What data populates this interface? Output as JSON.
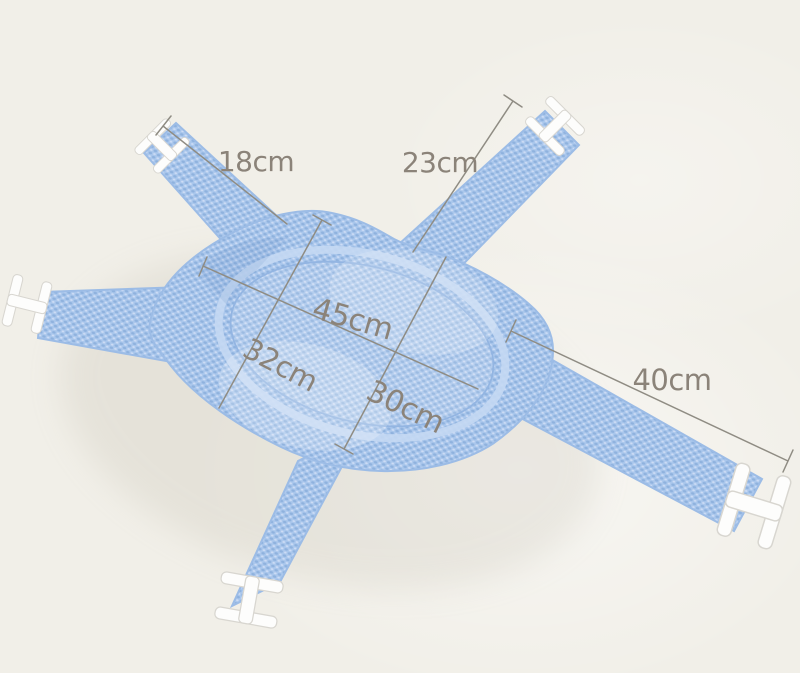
{
  "photo": {
    "subject": "Blue mesh baby bath support net with five straps and white plastic buckles, annotated with size measurements"
  },
  "labels": {
    "top_left_strap": "18cm",
    "top_right_strap": "23cm",
    "pad_length": "45cm",
    "pad_width_left": "32cm",
    "pad_width_right": "30cm",
    "right_strap": "40cm"
  },
  "colors": {
    "background": "#f1efe8",
    "mesh": "#aac7ec",
    "mesh_shadow": "#8fb2de",
    "mesh_highlight": "#cddcf5",
    "mesh_edge": "#9cbce6",
    "buckle": "#fdfdfc",
    "line": "#8f8c83",
    "label_text": "#8b8379"
  }
}
